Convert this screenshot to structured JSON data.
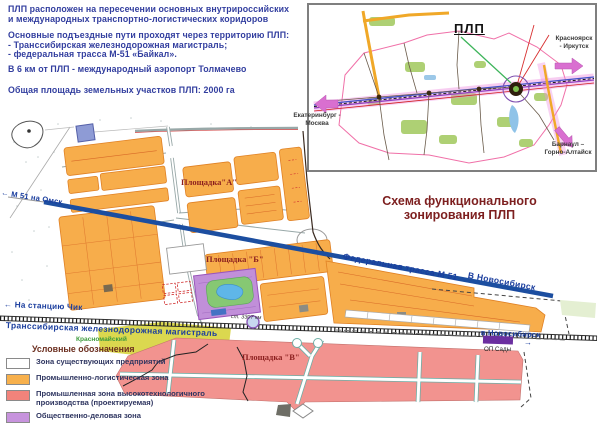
{
  "intro": {
    "lines": [
      "ПЛП расположен на пересечении основных внутрироссийских",
      "и международных транспортно-логистических коридоров",
      "Основные подъездные пути проходят через территорию ПЛП:",
      "- Транссибирская железнодорожная магистраль;",
      "- федеральная трасса М-51 «Байкал».",
      "В 6 км  от ПЛП - международный аэропорт Толмачево",
      "Общая площадь земельных участков ПЛП: 2000 га"
    ]
  },
  "inset": {
    "title": "ПЛП",
    "west": "Екатеринбург -\nМосква",
    "east": "Красноярск\n- Иркутск",
    "south": "Барнаул –\nГорно-Алтайск"
  },
  "map": {
    "title_line1": "Схема функционального",
    "title_line2": "зонирования ПЛП",
    "m51_west_arrow": "←",
    "m51_west": "М 51 на Омск",
    "m51_label": "Федеральная трасса М 51",
    "m51_east": "В Новосибирск",
    "m51_east_arrow": "→",
    "rail_label": "Транссибирская железнодорожная магистраль",
    "rail_west_arrow": "←",
    "rail_west": "На станцию Чик",
    "rail_km": "ст. 3307 км",
    "rail_east": "в Новосибирск",
    "rail_east_arrow": "→",
    "rail_stop": "ОП Сады",
    "site_a": "Площадка\"А\"",
    "site_b": "Площадка \"Б\"",
    "site_v": "Площадка \"В\"",
    "district": "Красномайский"
  },
  "legend": {
    "title": "Условные обозначения",
    "items": [
      {
        "label": "Зона существующих предприятий",
        "color": "#FFFFFF"
      },
      {
        "label": "Промышленно-логистическая зона",
        "color": "#F7B04C"
      },
      {
        "label": "Промышленная зона высокотехнологичного\nпроизводства (проектируемая)",
        "color": "#F2837B"
      },
      {
        "label": "Общественно-деловая зона",
        "color": "#C793DD"
      }
    ]
  },
  "colors": {
    "highway": "#1C4EA0",
    "intro_text": "#323E9F",
    "map_title": "#7D1F1F",
    "site_label": "#8B1E1E",
    "industrial_orange": "#F7AD4B",
    "hightech_pink": "#F2938F",
    "business_purple": "#C18FD9",
    "district_yellow": "#DBD84F"
  }
}
